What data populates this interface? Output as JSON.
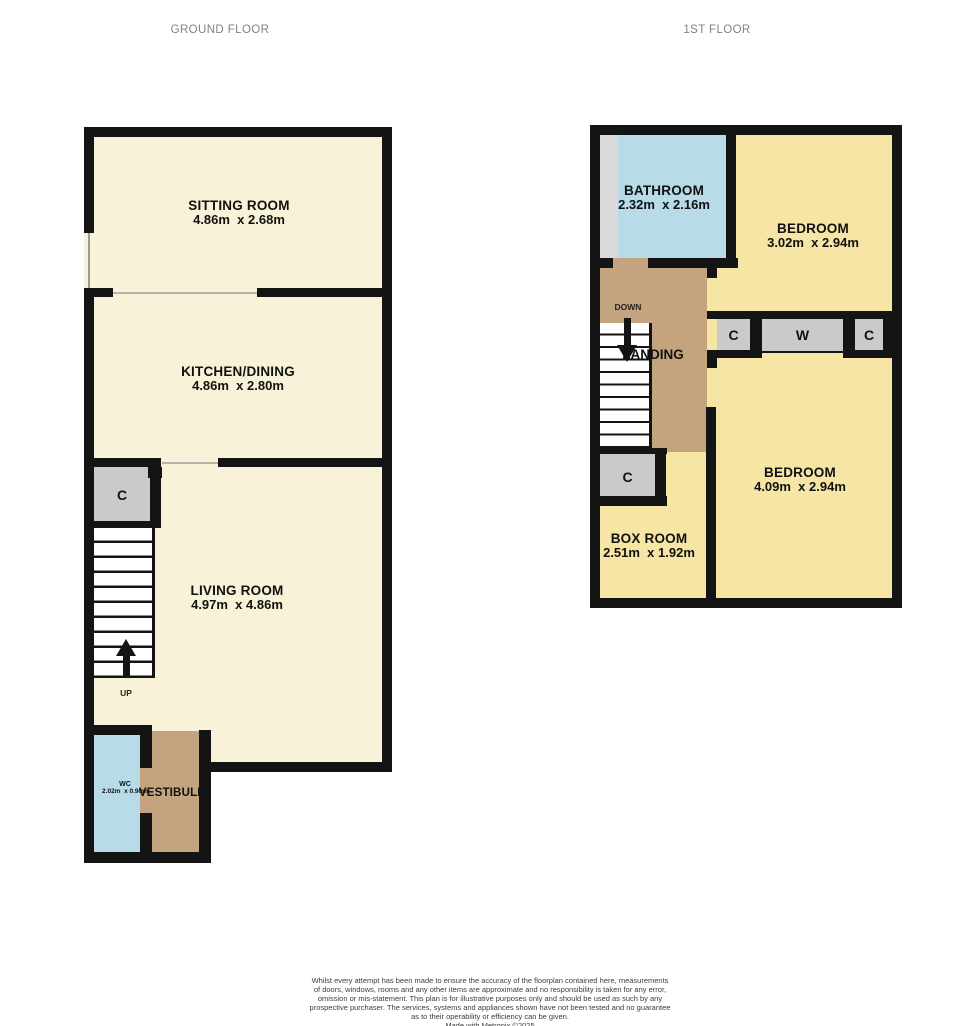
{
  "titles": {
    "ground": "GROUND FLOOR",
    "first": "1ST FLOOR"
  },
  "ground": {
    "sitting": {
      "name": "SITTING ROOM",
      "dims": "4.86m  x 2.68m"
    },
    "kitchen": {
      "name": "KITCHEN/DINING",
      "dims": "4.86m  x 2.80m"
    },
    "living": {
      "name": "LIVING ROOM",
      "dims": "4.97m  x 4.86m"
    },
    "wc": {
      "name": "WC",
      "dims": "2.02m  x 0.90m"
    },
    "vestibule": {
      "name": "VESTIBULE"
    },
    "closet_label": "C",
    "up_label": "UP"
  },
  "first": {
    "bathroom": {
      "name": "BATHROOM",
      "dims": "2.32m  x 2.16m"
    },
    "bedroom_top": {
      "name": "BEDROOM",
      "dims": "3.02m  x 2.94m"
    },
    "bedroom_bottom": {
      "name": "BEDROOM",
      "dims": "4.09m  x 2.94m"
    },
    "boxroom": {
      "name": "BOX ROOM",
      "dims": "2.51m  x 1.92m"
    },
    "landing": {
      "name": "LANDING"
    },
    "down_label": "DOWN",
    "closet_c1": "C",
    "closet_w": "W",
    "closet_c2": "C",
    "closet_c3": "C"
  },
  "footer": {
    "lines": [
      "Whilst every attempt has been made to ensure the accuracy of the floorplan contained here, measurements",
      "of doors, windows, rooms and any other items are approximate and no responsibility is taken for any error,",
      "omission or mis-statement. This plan is for illustrative purposes only and should be used as such by any",
      "prospective purchaser. The services, systems and appliances shown have not been tested and no guarantee",
      "as to their operability or efficiency can be given."
    ],
    "credit": "Made with Metropix ©2025"
  },
  "colors": {
    "wall": "#141414",
    "cream": "#f8f2d8",
    "yellow": "#f6e5a4",
    "blue": "#b7dbe7",
    "tan": "#c4a47f",
    "closet": "#cacaca",
    "strip": "#dadada"
  }
}
